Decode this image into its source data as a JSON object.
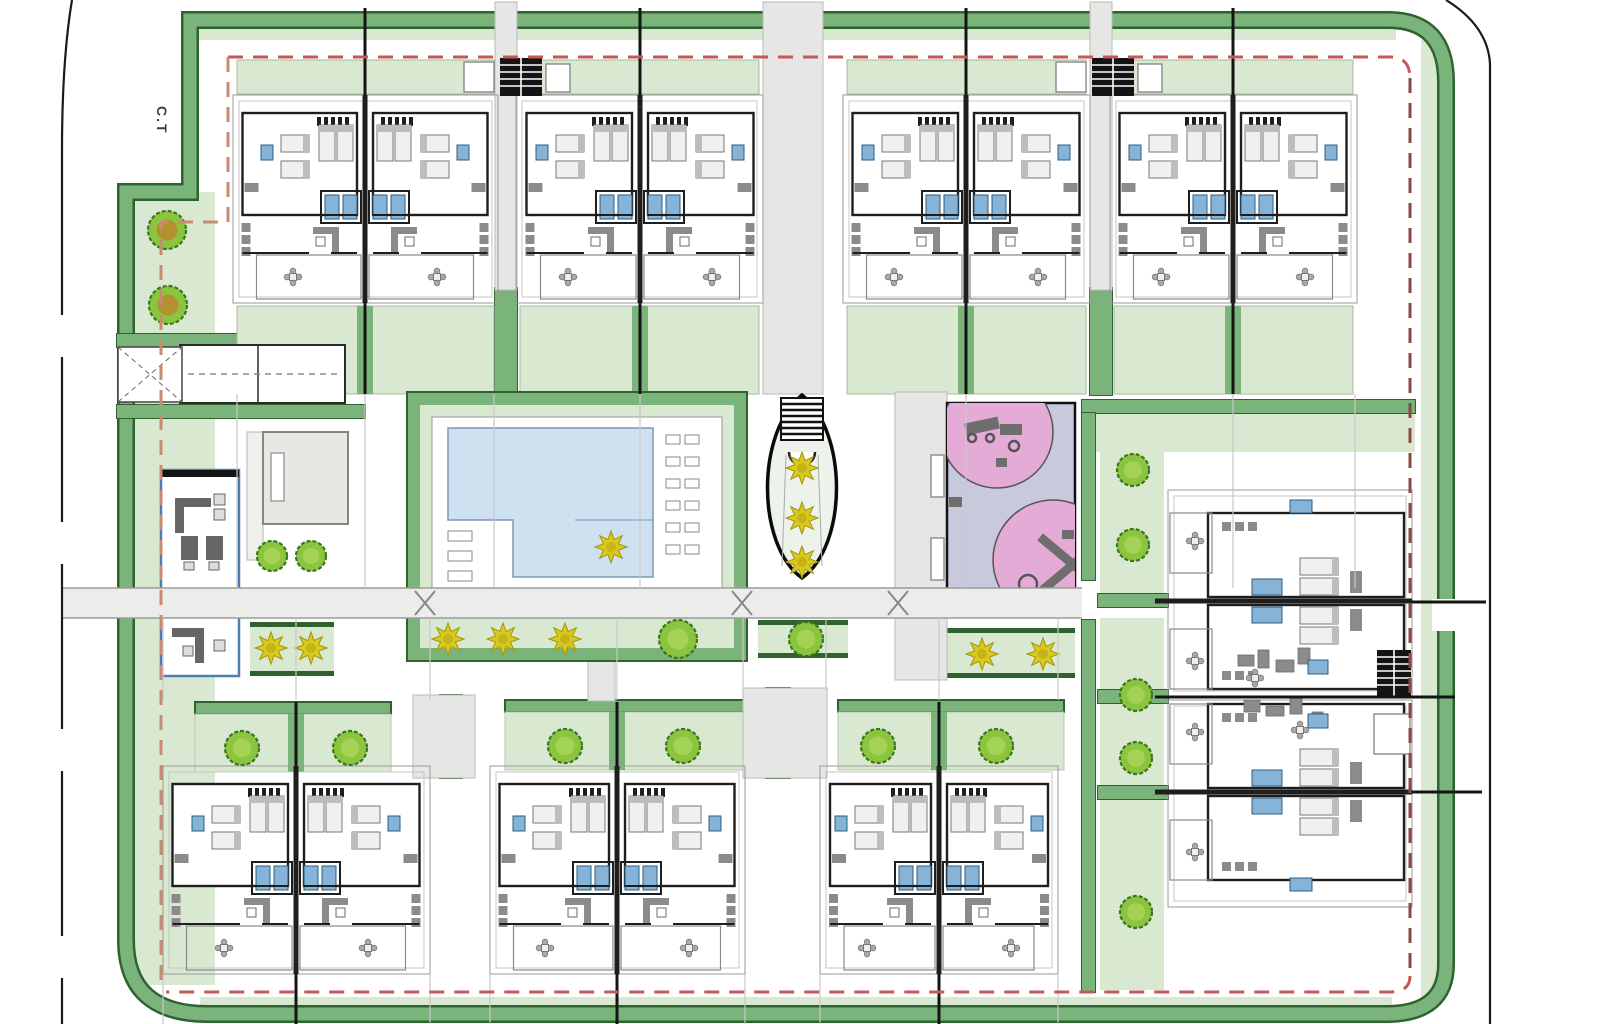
{
  "labels": {
    "corner_label": "C.T"
  },
  "colors": {
    "band": "#7ab47b",
    "bandDark": "#2e6330",
    "pale": "#d9e8d1",
    "road": "#ececea",
    "roadLine": "#9b9b99",
    "path": "#e6e6e4",
    "pathS": "#b9b9b7",
    "water": "#cfe1f1",
    "waterS": "#7e98b0",
    "lavender": "#c9c9de",
    "pink": "#e3abd6",
    "equip": "#6e6e6e",
    "tree": "#8bc53f",
    "treeS": "#3a761d",
    "treeIn": "#a4d255",
    "olive": "#b2912e",
    "plantY": "#d9c91d",
    "plantS": "#a3950e",
    "red": "#c45a55",
    "salmon": "#c98a72",
    "maroon": "#8a4a44",
    "wall": "#1e1e1e",
    "plot": "#9a9a9a",
    "roof": "#c4c4c4",
    "furn": "#8b8b8b",
    "furnS": "#6a6a6a",
    "bedF": "#f0f0f0",
    "bedS": "#777777",
    "pillow": "#bdbdbd",
    "blue": "#85b4d8",
    "blueS": "#2c5c80",
    "thin": "#c9c9c9",
    "grayBldg": "#e7e7e3",
    "grayBldgS": "#858583",
    "office": "#4a7fae",
    "black": "#141414",
    "ovalFill": "#edf2ea"
  },
  "scene": {
    "palePatches": [
      [
        135,
        192,
        80,
        793
      ],
      [
        198,
        29,
        1198,
        11
      ],
      [
        1421,
        40,
        18,
        958
      ],
      [
        200,
        997,
        1192,
        11
      ],
      [
        1096,
        414,
        319,
        38
      ],
      [
        1100,
        452,
        64,
        156
      ],
      [
        1100,
        618,
        64,
        170
      ],
      [
        1100,
        795,
        64,
        195
      ]
    ],
    "bandPath": "M126,940 V192 H190 V20 H1388 Q1446,20 1446,82 V964 Q1446,1014 1386,1014 H208 Q126,1014 126,940",
    "hedges": [
      [
        495,
        288,
        22,
        107
      ],
      [
        1090,
        288,
        22,
        107
      ],
      [
        440,
        695,
        22,
        83
      ],
      [
        766,
        688,
        24,
        90
      ],
      [
        1098,
        594,
        70,
        13
      ],
      [
        1098,
        690,
        70,
        13
      ],
      [
        1098,
        786,
        70,
        13
      ],
      [
        117,
        334,
        230,
        13
      ],
      [
        117,
        405,
        248,
        13
      ],
      [
        1082,
        400,
        333,
        13
      ],
      [
        1082,
        413,
        13,
        167
      ],
      [
        1082,
        620,
        13,
        372
      ]
    ],
    "plantStrips": [
      [
        420,
        620,
        314,
        28
      ],
      [
        758,
        620,
        90,
        28
      ],
      [
        945,
        628,
        130,
        40
      ],
      [
        250,
        622,
        84,
        44
      ]
    ],
    "bottomStrips": [
      [
        195,
        702,
        196,
        296
      ],
      [
        505,
        700,
        240,
        617
      ],
      [
        838,
        700,
        226,
        939
      ]
    ],
    "paths": [
      [
        763,
        2,
        60,
        392
      ],
      [
        495,
        2,
        22,
        288
      ],
      [
        1090,
        2,
        22,
        288
      ],
      [
        895,
        392,
        52,
        288
      ],
      [
        588,
        615,
        27,
        86
      ],
      [
        413,
        695,
        62,
        83
      ],
      [
        743,
        688,
        84,
        90
      ]
    ],
    "road": [
      61,
      588,
      1021,
      30
    ],
    "roadGap": [
      1432,
      599,
      26,
      32
    ],
    "xmarks": [
      [
        425,
        603
      ],
      [
        742,
        603
      ],
      [
        898,
        603
      ]
    ],
    "topBuildings": [
      [
        233,
        265,
        365
      ],
      [
        516,
        247,
        640
      ],
      [
        843,
        247,
        966
      ],
      [
        1110,
        247,
        1233
      ]
    ],
    "bottomBuildings": [
      [
        163,
        267,
        296
      ],
      [
        490,
        255,
        617
      ],
      [
        820,
        238,
        939
      ]
    ],
    "rightBuildings": [
      [
        490,
        207,
        601
      ],
      [
        700,
        207,
        792
      ]
    ],
    "trees": [
      [
        167,
        230,
        19,
        "olive"
      ],
      [
        168,
        305,
        19,
        "olive"
      ],
      [
        272,
        556,
        15,
        "g"
      ],
      [
        311,
        556,
        15,
        "g"
      ],
      [
        678,
        639,
        19,
        "g"
      ],
      [
        806,
        639,
        17,
        "g"
      ],
      [
        1133,
        470,
        16,
        "g"
      ],
      [
        1133,
        545,
        16,
        "g"
      ],
      [
        1136,
        695,
        16,
        "g"
      ],
      [
        1136,
        758,
        16,
        "g"
      ],
      [
        1136,
        912,
        16,
        "g"
      ],
      [
        242,
        748,
        17,
        "g"
      ],
      [
        350,
        748,
        17,
        "g"
      ],
      [
        565,
        746,
        17,
        "g"
      ],
      [
        683,
        746,
        17,
        "g"
      ],
      [
        878,
        746,
        17,
        "g"
      ],
      [
        996,
        746,
        17,
        "g"
      ]
    ],
    "plants": [
      [
        448,
        639
      ],
      [
        503,
        639
      ],
      [
        565,
        639
      ],
      [
        611,
        547
      ],
      [
        982,
        654
      ],
      [
        1043,
        654
      ],
      [
        271,
        648
      ],
      [
        311,
        648
      ],
      [
        802,
        468
      ],
      [
        802,
        518
      ],
      [
        802,
        562
      ]
    ],
    "pool": {
      "x": 408,
      "y": 393,
      "w": 338,
      "h": 267,
      "deck": [
        432,
        417,
        290,
        173
      ],
      "water": "M448,428 H653 V577 H513 V520 H448 Z"
    },
    "loungers": {
      "right": [
        666,
        435,
        2,
        6,
        19,
        22,
        14,
        9
      ],
      "left": [
        448,
        531,
        1,
        3,
        0,
        20,
        24,
        10
      ]
    },
    "oval": {
      "d": "M802,395 C848,432 848,545 802,578 C756,545 756,432 802,395 Z",
      "stairs": [
        781,
        398,
        42,
        42
      ],
      "arc": "M789,452 a13,13 0 0 0 26,0",
      "guides": [
        [
          786,
          455,
          782,
          566
        ],
        [
          818,
          455,
          822,
          566
        ]
      ]
    },
    "playground": {
      "x": 947,
      "y": 403,
      "w": 128,
      "h": 190,
      "circles": [
        [
          997,
          432,
          56
        ],
        [
          1053,
          560,
          60
        ]
      ],
      "equip": [
        [
          965,
          420,
          34,
          12,
          -12
        ],
        [
          1000,
          424,
          22,
          11,
          0
        ],
        [
          996,
          458,
          11,
          9,
          0
        ],
        [
          949,
          497,
          13,
          10,
          0
        ],
        [
          1034,
          549,
          52,
          9,
          40
        ],
        [
          1034,
          571,
          52,
          9,
          -40
        ],
        [
          1062,
          530,
          12,
          9,
          0
        ]
      ],
      "equipCircles": [
        [
          972,
          438,
          4
        ],
        [
          990,
          438,
          4
        ],
        [
          1014,
          446,
          5
        ],
        [
          1028,
          584,
          9
        ]
      ]
    },
    "office": {
      "x": 163,
      "y": 470,
      "w": 74,
      "h": 206,
      "rects": [
        [
          175,
          498,
          36,
          9
        ],
        [
          175,
          507,
          9,
          26
        ],
        [
          181,
          536,
          17,
          24
        ],
        [
          206,
          536,
          17,
          24
        ],
        [
          172,
          628,
          32,
          9
        ],
        [
          195,
          637,
          9,
          26
        ]
      ],
      "small": [
        [
          214,
          494,
          11,
          11
        ],
        [
          214,
          509,
          11,
          11
        ],
        [
          184,
          562,
          10,
          8
        ],
        [
          209,
          562,
          10,
          8
        ],
        [
          183,
          646,
          10,
          10
        ],
        [
          214,
          640,
          11,
          11
        ]
      ]
    },
    "grayBuilding": {
      "x": 263,
      "y": 432,
      "w": 85,
      "h": 92,
      "slot": [
        271,
        453,
        13,
        48
      ],
      "side": [
        247,
        432,
        16,
        128
      ]
    },
    "entrance": {
      "box": [
        180,
        345,
        165,
        58
      ],
      "div": 258,
      "tri": [
        118,
        347,
        64,
        55
      ]
    },
    "hatches": [
      [
        500,
        58,
        42,
        38
      ],
      [
        1092,
        58,
        42,
        38
      ],
      [
        1377,
        650,
        34,
        46
      ]
    ],
    "whiteBoxes": [
      [
        464,
        62,
        30,
        30
      ],
      [
        546,
        64,
        24,
        28
      ],
      [
        1056,
        62,
        30,
        30
      ],
      [
        1138,
        64,
        24,
        28
      ],
      [
        1374,
        714,
        36,
        40
      ],
      [
        931,
        455,
        13,
        42
      ],
      [
        931,
        538,
        13,
        42
      ]
    ],
    "clusterRects": [
      [
        1238,
        655,
        16,
        11
      ],
      [
        1258,
        650,
        11,
        18
      ],
      [
        1276,
        660,
        18,
        12
      ],
      [
        1298,
        648,
        12,
        16
      ],
      [
        1244,
        700,
        16,
        12
      ],
      [
        1266,
        706,
        18,
        10
      ],
      [
        1290,
        696,
        12,
        18
      ],
      [
        1312,
        712,
        11,
        11
      ]
    ],
    "clusterBlues": [
      [
        1308,
        660,
        20,
        14
      ],
      [
        1308,
        714,
        20,
        14
      ],
      [
        1290,
        500,
        22,
        13
      ],
      [
        1290,
        878,
        22,
        13
      ]
    ],
    "blackSegs": [
      [
        365,
        8,
        365,
        95
      ],
      [
        640,
        8,
        640,
        95
      ],
      [
        966,
        8,
        966,
        95
      ],
      [
        1233,
        8,
        1233,
        95
      ],
      [
        365,
        303,
        365,
        394
      ],
      [
        640,
        303,
        640,
        394
      ],
      [
        966,
        303,
        966,
        394
      ],
      [
        1233,
        303,
        1233,
        394
      ],
      [
        296,
        702,
        296,
        766
      ],
      [
        617,
        702,
        617,
        766
      ],
      [
        939,
        702,
        939,
        766
      ],
      [
        296,
        974,
        296,
        1024
      ],
      [
        617,
        974,
        617,
        1024
      ],
      [
        939,
        974,
        939,
        1024
      ],
      [
        1412,
        602,
        1486,
        602
      ],
      [
        1155,
        697,
        1455,
        697
      ],
      [
        1412,
        792,
        1482,
        792
      ]
    ],
    "thinSegs": [
      [
        237,
        394,
        237,
        588
      ],
      [
        365,
        394,
        365,
        588
      ],
      [
        494,
        394,
        494,
        588
      ],
      [
        640,
        394,
        640,
        588
      ],
      [
        966,
        394,
        966,
        588
      ],
      [
        1233,
        394,
        1233,
        588
      ],
      [
        1355,
        394,
        1355,
        588
      ],
      [
        163,
        618,
        163,
        700
      ],
      [
        296,
        618,
        296,
        700
      ],
      [
        430,
        618,
        430,
        700
      ],
      [
        617,
        618,
        617,
        700
      ],
      [
        743,
        618,
        743,
        688
      ],
      [
        826,
        618,
        826,
        688
      ],
      [
        939,
        618,
        939,
        700
      ],
      [
        1058,
        618,
        1058,
        700
      ],
      [
        163,
        974,
        163,
        1024
      ],
      [
        430,
        974,
        430,
        1024
      ],
      [
        490,
        974,
        490,
        1024
      ],
      [
        745,
        974,
        745,
        1024
      ],
      [
        820,
        974,
        820,
        1024
      ],
      [
        1058,
        974,
        1058,
        1024
      ]
    ],
    "roadLines": {
      "leftSolid": "M72,0 Q62,60 62,150",
      "leftDash": "M62,150 V1024",
      "right": "M1446,0 Q1488,26 1490,64 V1024"
    },
    "redPaths": [
      {
        "d": "M228,57 H1390 Q1410,57 1410,78",
        "c": "red"
      },
      {
        "d": "M1410,78 V976",
        "c": "maroon"
      },
      {
        "d": "M1410,976 Q1410,992 1390,992 H166",
        "c": "red"
      },
      {
        "d": "M228,57 V222 H161 V990",
        "c": "salmon"
      }
    ]
  }
}
